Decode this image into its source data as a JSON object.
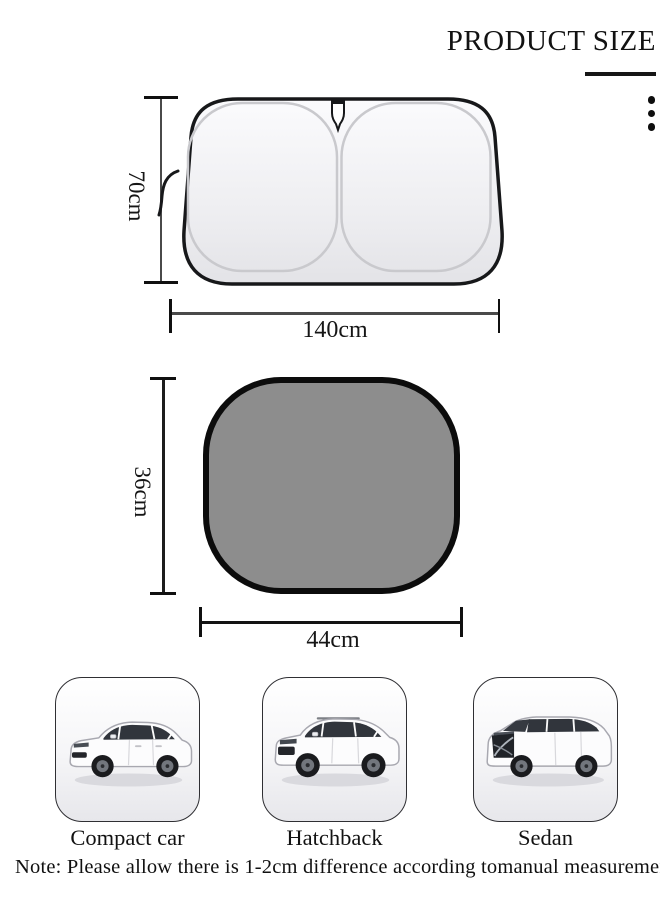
{
  "title": "PRODUCT SIZE",
  "windshield_shade": {
    "height": "70cm",
    "width": "140cm"
  },
  "window_shade": {
    "height": "36cm",
    "width": "44cm"
  },
  "cars": [
    {
      "label": "Compact car"
    },
    {
      "label": "Hatchback"
    },
    {
      "label": "Sedan"
    }
  ],
  "note": "Note: Please allow there is 1-2cm difference according tomanual measurement",
  "icons": {
    "overflow_menu": "vertical-ellipsis"
  },
  "colors": {
    "shade_fill": "#8d8d8d",
    "outline": "#17181a",
    "wire": "#c9c9cd",
    "dim_line": "#4a4a4a"
  }
}
